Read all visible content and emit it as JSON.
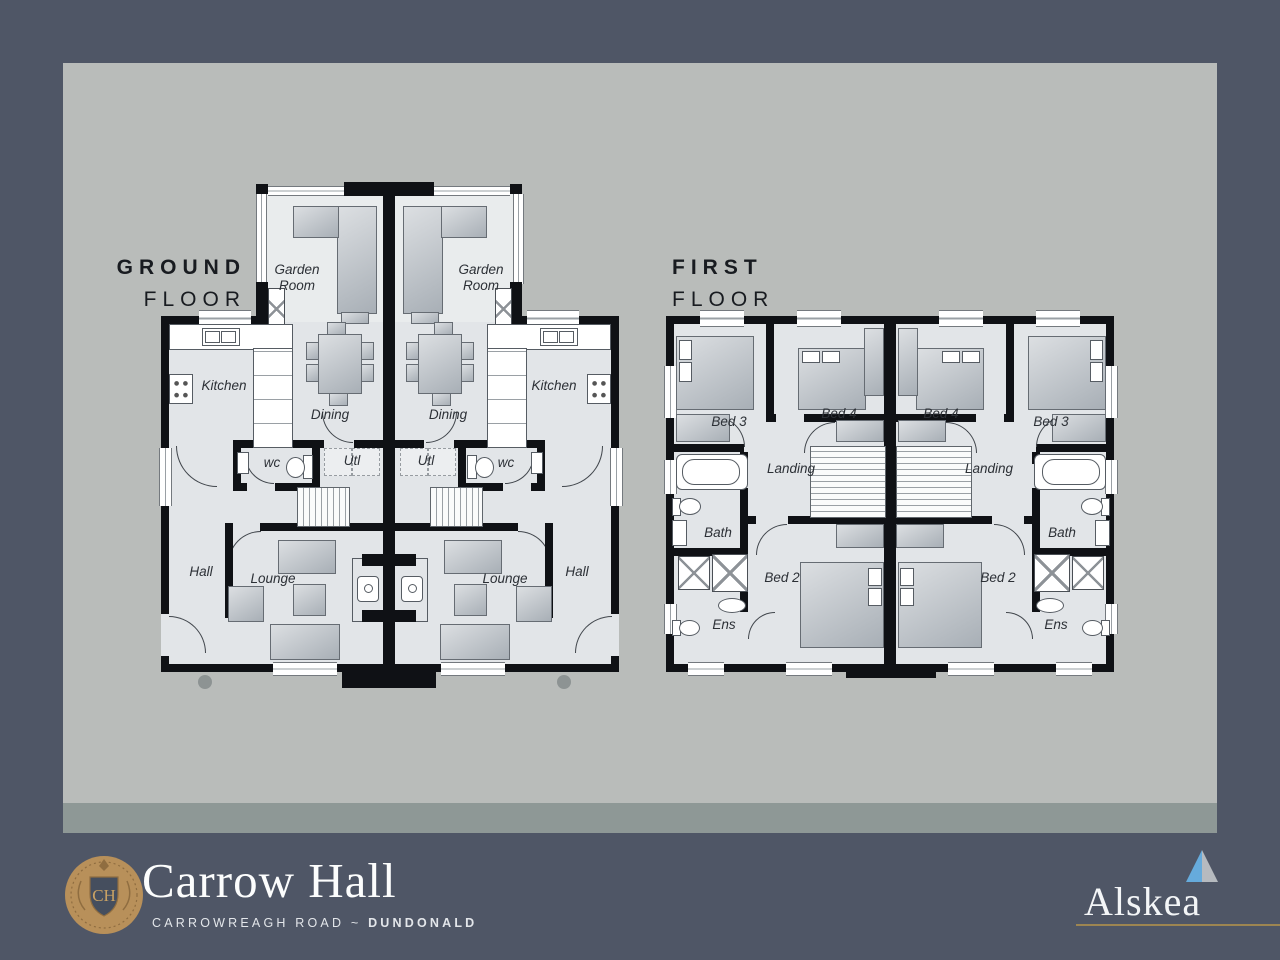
{
  "ground_floor": {
    "title_line1": "GROUND",
    "title_line2": "FLOOR",
    "left_unit": {
      "garden_room": "Garden Room",
      "kitchen": "Kitchen",
      "dining": "Dining",
      "wc": "wc",
      "utility": "Utl",
      "hall": "Hall",
      "lounge": "Lounge"
    },
    "right_unit": {
      "garden_room": "Garden Room",
      "kitchen": "Kitchen",
      "dining": "Dining",
      "wc": "wc",
      "utility": "Utl",
      "hall": "Hall",
      "lounge": "Lounge"
    }
  },
  "first_floor": {
    "title_line1": "FIRST",
    "title_line2": "FLOOR",
    "left_unit": {
      "bed3": "Bed 3",
      "bed4": "Bed 4",
      "landing": "Landing",
      "bath": "Bath",
      "bed2": "Bed 2",
      "ens": "Ens"
    },
    "right_unit": {
      "bed3": "Bed 3",
      "bed4": "Bed 4",
      "landing": "Landing",
      "bath": "Bath",
      "bed2": "Bed 2",
      "ens": "Ens"
    }
  },
  "branding": {
    "monogram": "CH",
    "development_name": "Carrow Hall",
    "address_road": "CARROWREAGH ROAD",
    "address_separator": "~",
    "address_town": "DUNDONALD",
    "builder_name": "Alskea"
  },
  "colors": {
    "background": "#4f5666",
    "panel": "#b9bcba",
    "panel_strip": "#8e9896",
    "floor": "#e2e5e8",
    "wall": "#0f1115",
    "accent_gold": "#9d8551",
    "crest_gold": "#b8905a",
    "alskea_blue": "#66abdc",
    "alskea_gray": "#b6babf"
  }
}
